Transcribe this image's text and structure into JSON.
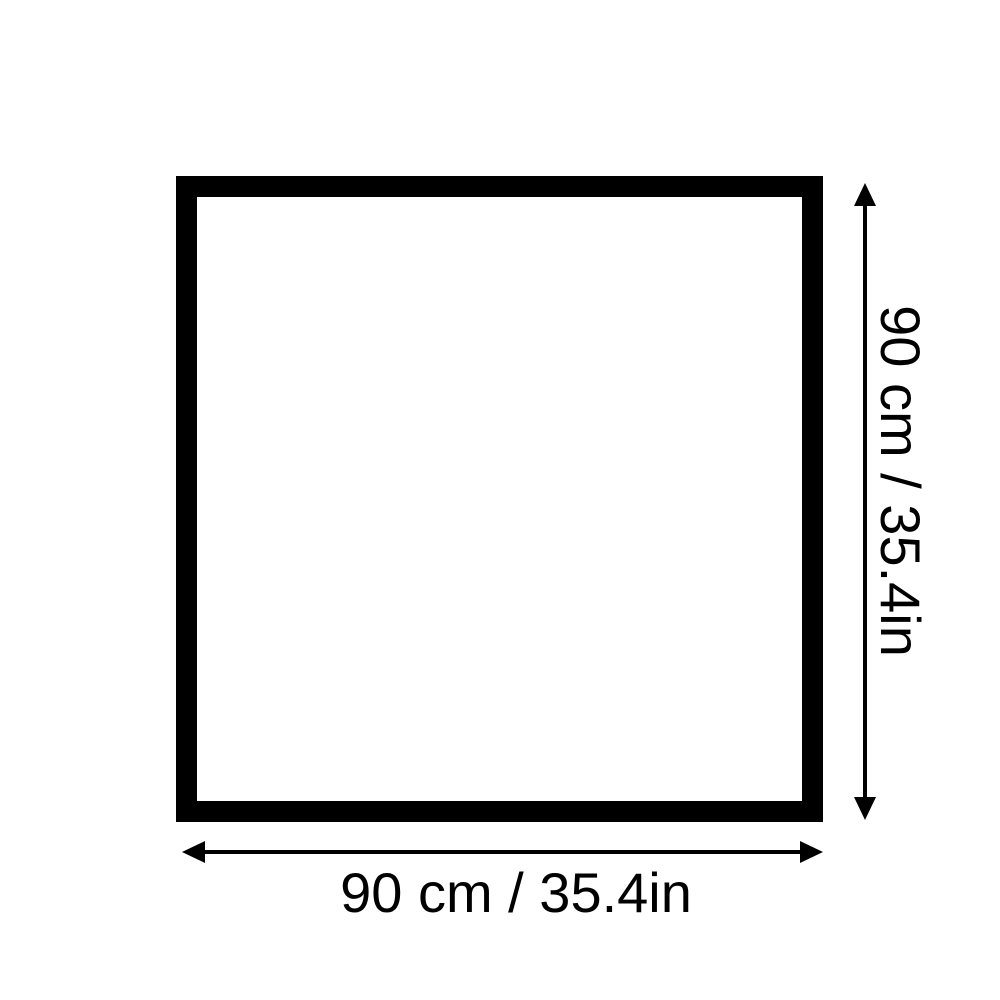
{
  "diagram": {
    "title": "square-dimension-diagram",
    "shape": "square",
    "width_label": "90 cm / 35.4in",
    "height_label": "90 cm / 35.4in",
    "width_cm": 90,
    "height_cm": 90,
    "width_in": 35.4,
    "height_in": 35.4,
    "line_color": "#000000",
    "background_color": "#ffffff"
  }
}
